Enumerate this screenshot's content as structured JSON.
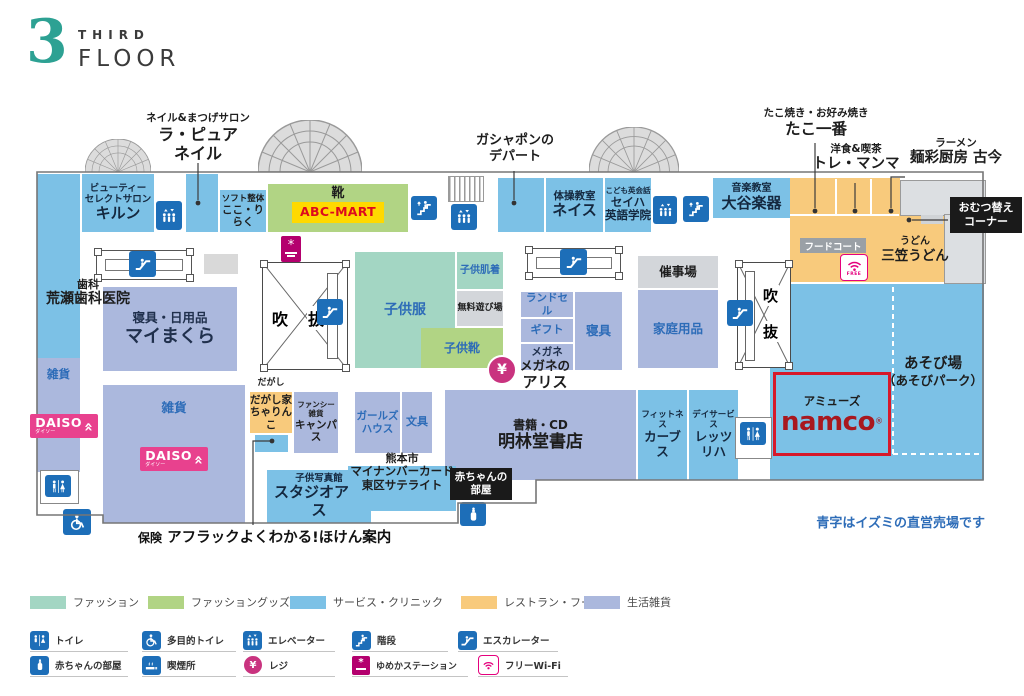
{
  "header": {
    "number": "3",
    "word1": "THIRD",
    "word2": "FLOOR"
  },
  "callouts": {
    "nail": {
      "lines": [
        "ネイル&まつげサロン",
        "ラ・ピュア",
        "ネイル"
      ]
    },
    "gashapon": {
      "lines": [
        "ガシャポンの",
        "デパート"
      ]
    },
    "tako": {
      "lines": [
        "たこ焼き・お好み焼き",
        "たこ一番"
      ]
    },
    "tremamma": {
      "lines": [
        "洋食&喫茶",
        "トレ・マンマ"
      ]
    },
    "kokon": {
      "lines": [
        "ラーメン",
        "麺彩厨房 古今"
      ]
    },
    "omutsu": {
      "lines": [
        "おむつ替え",
        "コーナー"
      ]
    },
    "hoken": {
      "prefix": "保険",
      "name": "アフラックよくわかる!ほけん案内"
    }
  },
  "rooms": {
    "kiln": {
      "lines": [
        "ビューティー",
        "セレクトサロン",
        "キルン"
      ]
    },
    "kokoriraku": {
      "lines": [
        "ソフト整体",
        "ここ・りらく"
      ]
    },
    "abcmart": {
      "category": "靴",
      "brand": "ABC-MART"
    },
    "neisu": {
      "lines": [
        "体操教室",
        "ネイス"
      ]
    },
    "seiha": {
      "lines": [
        "こども英会話",
        "セイハ",
        "英語学院"
      ]
    },
    "otani": {
      "lines": [
        "音楽教室",
        "大谷楽器"
      ]
    },
    "arase": {
      "lines": [
        "歯科",
        "荒瀬歯科医院"
      ]
    },
    "maimakura": {
      "lines": [
        "寝具・日用品",
        "マイまくら"
      ]
    },
    "fukinuke1": {
      "chars": [
        "吹",
        "抜"
      ]
    },
    "fukinuke2": {
      "chars": [
        "吹",
        "抜"
      ]
    },
    "kodomofuku": {
      "label": "子供服"
    },
    "kodomohadagi": {
      "label": "子供肌着"
    },
    "muryoasobiba": {
      "label": "無料遊び場"
    },
    "kodomogutsu": {
      "label": "子供靴"
    },
    "randoseru": {
      "label": "ランドセル"
    },
    "gift": {
      "label": "ギフト"
    },
    "megane": {
      "label": "メガネ",
      "lines": [
        "メガネの",
        "アリス"
      ]
    },
    "shingu": {
      "label": "寝具"
    },
    "saijijo": {
      "label": "催事場"
    },
    "kateiyohin": {
      "label": "家庭用品"
    },
    "zakka_left": {
      "label": "雑貨"
    },
    "zakka_center": {
      "label": "雑貨"
    },
    "daiso": {
      "brand": "DAISO",
      "kana": "ダイソー"
    },
    "dagashiya": {
      "category": "だがし",
      "lines": [
        "だがし家",
        "ちゃりんこ"
      ]
    },
    "campus": {
      "lines": [
        "ファンシー雑貨",
        "キャンパス"
      ]
    },
    "girlshouse": {
      "lines": [
        "ガールズ",
        "ハウス"
      ]
    },
    "bungu": {
      "label": "文具"
    },
    "meirindo": {
      "lines": [
        "書籍・CD",
        "明林堂書店"
      ]
    },
    "curves": {
      "lines": [
        "フィットネス",
        "カーブス"
      ]
    },
    "letsriha": {
      "lines": [
        "デイサービス",
        "レッツリハ"
      ]
    },
    "studioalice": {
      "lines": [
        "子供写真館",
        "スタジオアリス"
      ]
    },
    "mynumber": {
      "lines": [
        "熊本市",
        "マイナンバーカード",
        "東区サテライト"
      ]
    },
    "akachan": {
      "lines": [
        "赤ちゃんの",
        "部屋"
      ]
    },
    "foodcourt": {
      "label": "フードコート"
    },
    "mikasa": {
      "lines": [
        "うどん",
        "三笠うどん"
      ]
    },
    "asobiba": {
      "lines": [
        "あそび場",
        "（あそびパーク）"
      ]
    },
    "namco": {
      "category": "アミューズ",
      "brand": "namco",
      "reg": "®"
    }
  },
  "icons": {
    "yen": "¥",
    "wifi_free": "FREE"
  },
  "note": "青字はイズミの直営売場です",
  "legend": {
    "categories": [
      {
        "label": "ファッション",
        "color": "#a3d6c3"
      },
      {
        "label": "ファッショングッズ",
        "color": "#b1d484"
      },
      {
        "label": "サービス・クリニック",
        "color": "#7cc1e6"
      },
      {
        "label": "レストラン・フード",
        "color": "#f8ca7c"
      },
      {
        "label": "生活雑貨",
        "color": "#abb8dd"
      }
    ],
    "icons_row1": [
      {
        "name": "toilet-icon",
        "label": "トイレ"
      },
      {
        "name": "accessible-toilet-icon",
        "label": "多目的トイレ"
      },
      {
        "name": "elevator-icon",
        "label": "エレベーター"
      },
      {
        "name": "stairs-icon",
        "label": "階段"
      },
      {
        "name": "escalator-icon",
        "label": "エスカレーター"
      }
    ],
    "icons_row2": [
      {
        "name": "baby-room-icon",
        "label": "赤ちゃんの部屋"
      },
      {
        "name": "smoking-icon",
        "label": "喫煙所"
      },
      {
        "name": "register-icon",
        "label": "レジ"
      },
      {
        "name": "yumeka-station-icon",
        "label": "ゆめかステーション"
      },
      {
        "name": "free-wifi-icon",
        "label": "フリーWi-Fi"
      }
    ]
  }
}
